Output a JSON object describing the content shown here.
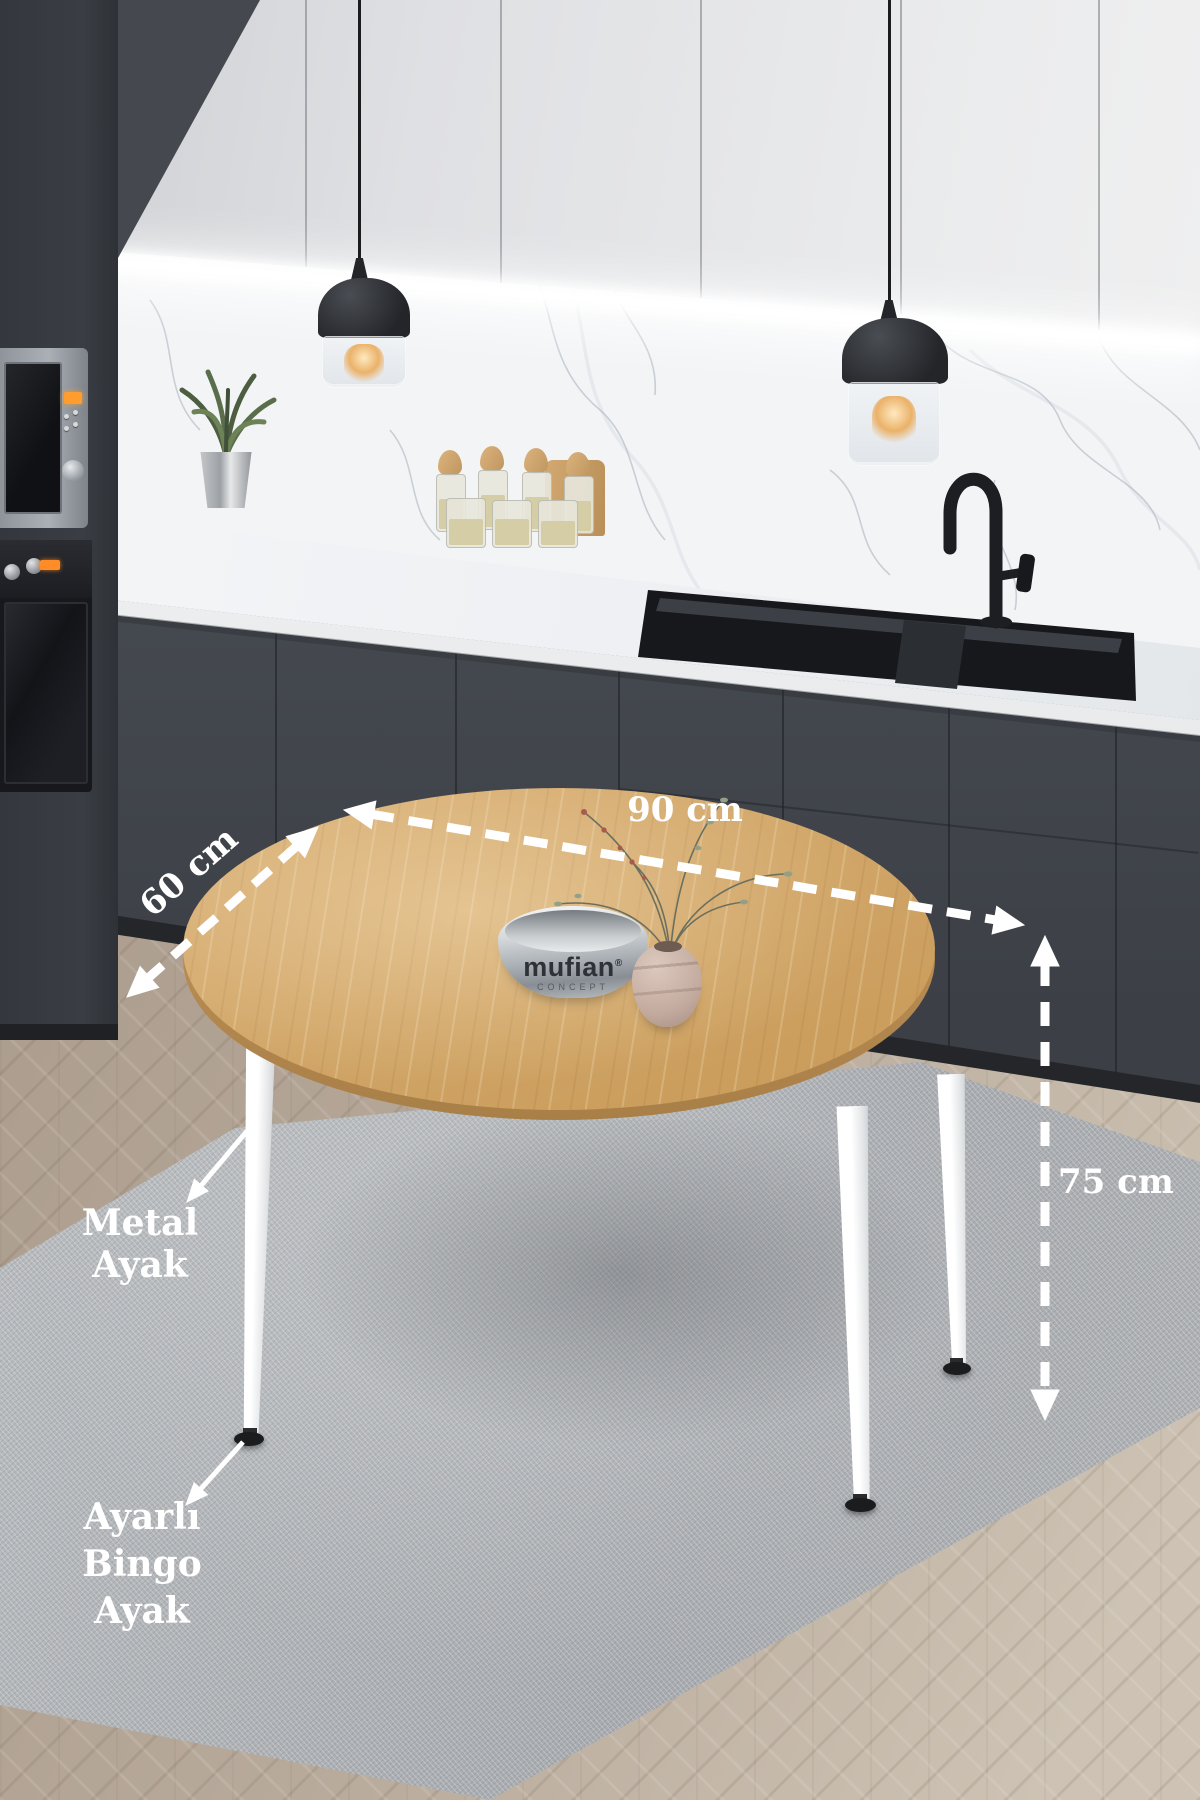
{
  "annotations": {
    "width": {
      "label": "90 cm"
    },
    "depth": {
      "label": "60 cm"
    },
    "height": {
      "label": "75 cm"
    },
    "metal_leg": {
      "label": "Metal Ayak"
    },
    "adjustable_foot": {
      "label_line1": "Ayarlı Bingo",
      "label_line2": "Ayak"
    },
    "color": "#ffffff"
  },
  "bowl_logo": {
    "brand": "mufian",
    "registered": "®",
    "sub": "CONCEPT"
  },
  "colors": {
    "upper_cabinet": "#e3e4e6",
    "lower_cabinet": "#474b52",
    "tall_cabinet": "#383b41",
    "countertop": "#eef0f2",
    "backsplash": "#f3f4f6",
    "table_wood": "#cda36a",
    "table_leg": "#f7f8f8",
    "rug": "#b0b3b6",
    "floor": "#b6a99c",
    "annotation": "#ffffff",
    "appliance_display": "#ff9c2e"
  }
}
